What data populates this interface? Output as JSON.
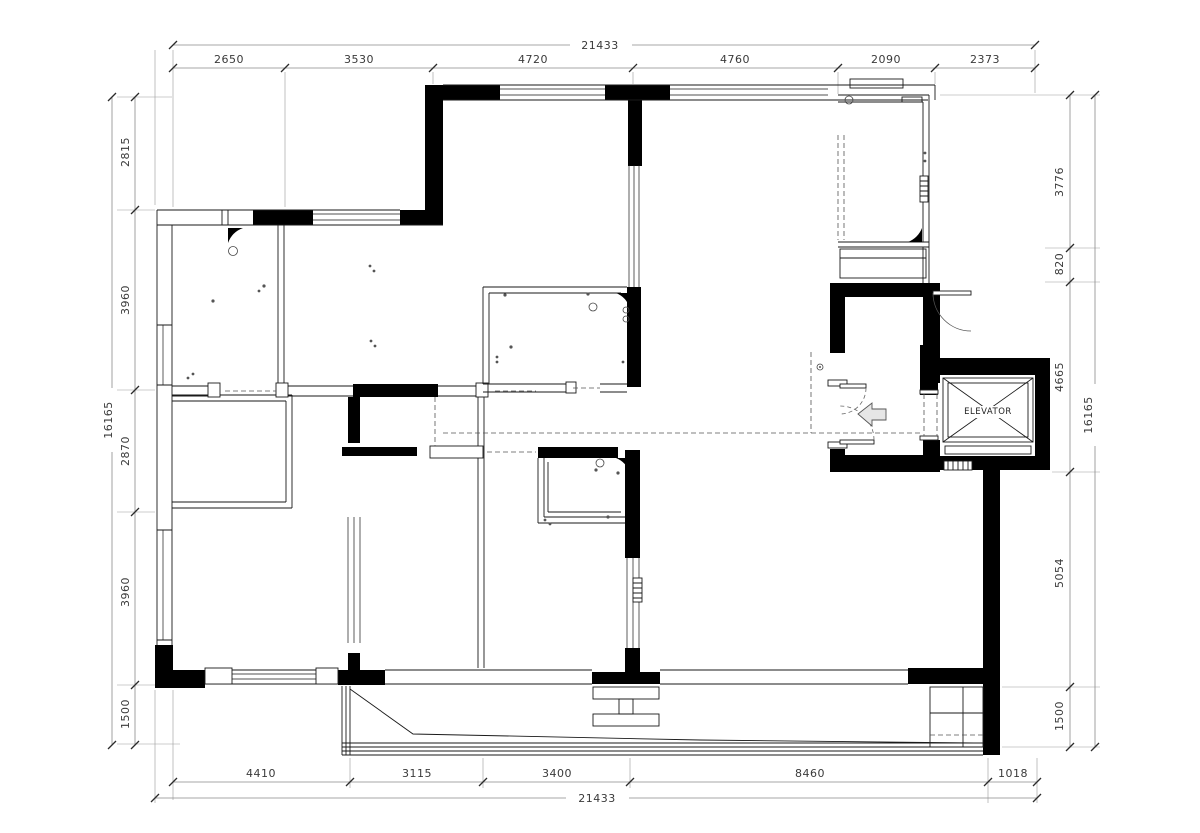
{
  "plan": {
    "elevator_label": "ELEVATOR"
  },
  "dims": {
    "top_total": "21433",
    "top": [
      "2650",
      "3530",
      "4720",
      "4760",
      "2090",
      "2373"
    ],
    "left_total": "16165",
    "left": [
      "2815",
      "3960",
      "2870",
      "3960",
      "1500"
    ],
    "right_total": "16165",
    "right": [
      "3776",
      "820",
      "4665",
      "5054",
      "1500"
    ],
    "bottom_total": "21433",
    "bottom": [
      "4410",
      "3115",
      "3400",
      "8460",
      "1018"
    ]
  }
}
